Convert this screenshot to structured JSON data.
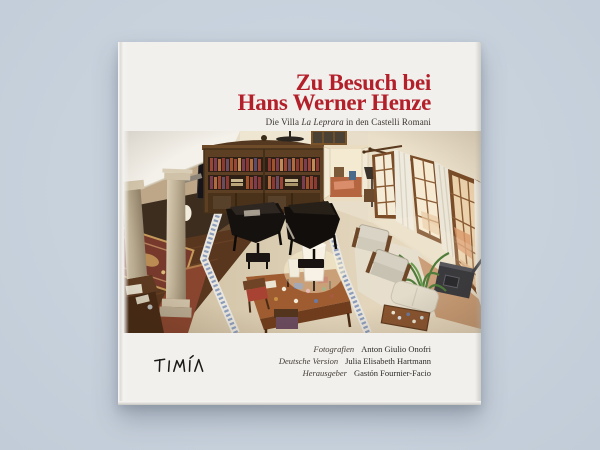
{
  "page": {
    "background_color": "#c8d2dd"
  },
  "book": {
    "cover_color": "#f1f0ed",
    "title_color": "#b3202a",
    "title_line1": "Zu Besuch bei",
    "title_line2": "Hans Werner Henze",
    "subtitle_prefix": "Die Villa ",
    "subtitle_villa": "La Leprara",
    "subtitle_suffix": " in den Castelli Romani",
    "credits": [
      {
        "label": "Fotografien",
        "name": "Anton Giulio Onofri"
      },
      {
        "label": "Deutsche Version",
        "name": "Julia Elisabeth Hartmann"
      },
      {
        "label": "Herausgeber",
        "name": "Gastón Fournier-Facio"
      }
    ],
    "publisher": "TIMÍA",
    "photo_alt": "Elevated wide-angle view of the Villa La Leprara living room: two black grand pianos before a tall wooden bookcase, stone columns and oriental rugs at left, a desk with a white lamp at center, armchairs, a plant, a dark stove and tall curtained windows at right"
  }
}
